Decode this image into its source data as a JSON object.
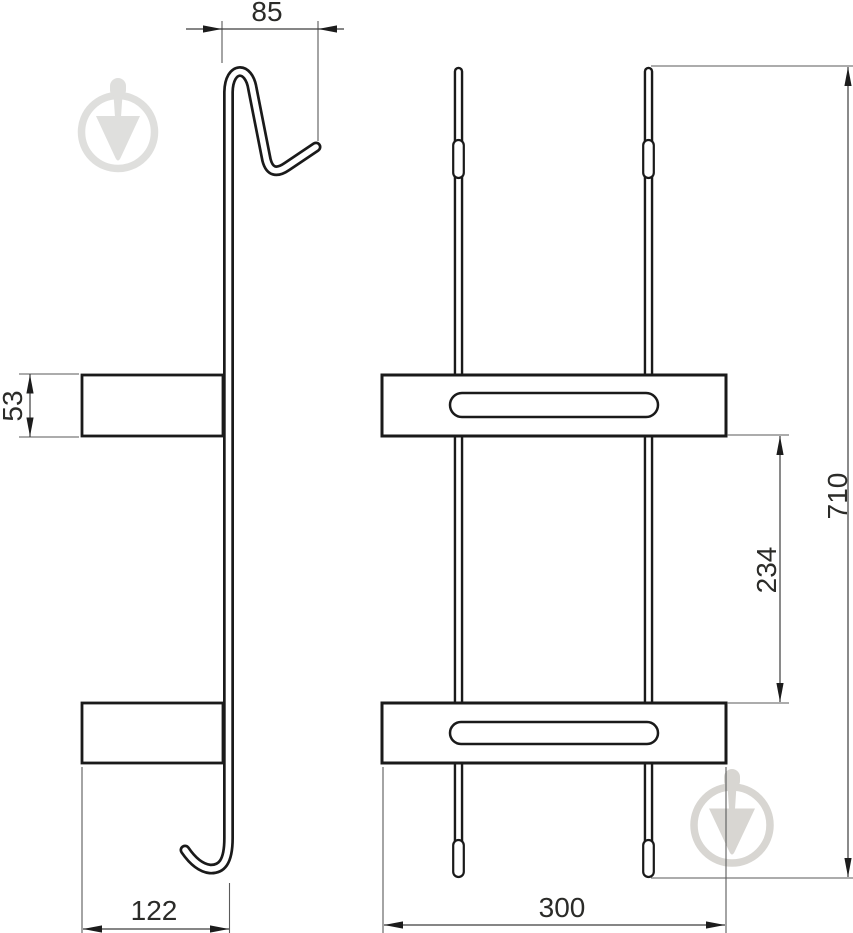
{
  "drawing": {
    "type": "technical-drawing",
    "subject": "two-tier over-door hanging rack, side view and front view",
    "units": "mm",
    "dimensions": {
      "hook_width": "85",
      "shelf_profile_height": "53",
      "shelf_depth": "122",
      "shelf_spacing": "234",
      "shelf_width": "300",
      "overall_height": "710"
    },
    "colors": {
      "background": "#ffffff",
      "object_line": "#1a1a1a",
      "dimension_line": "#3d3d3d",
      "text": "#2b2b28",
      "watermark_top_left": "#dfdfdd",
      "watermark_bottom_right": "#d8d6d2"
    },
    "watermark": {
      "icon": "trowel-in-circle-logo",
      "positions": [
        "top-left",
        "bottom-right"
      ]
    }
  }
}
